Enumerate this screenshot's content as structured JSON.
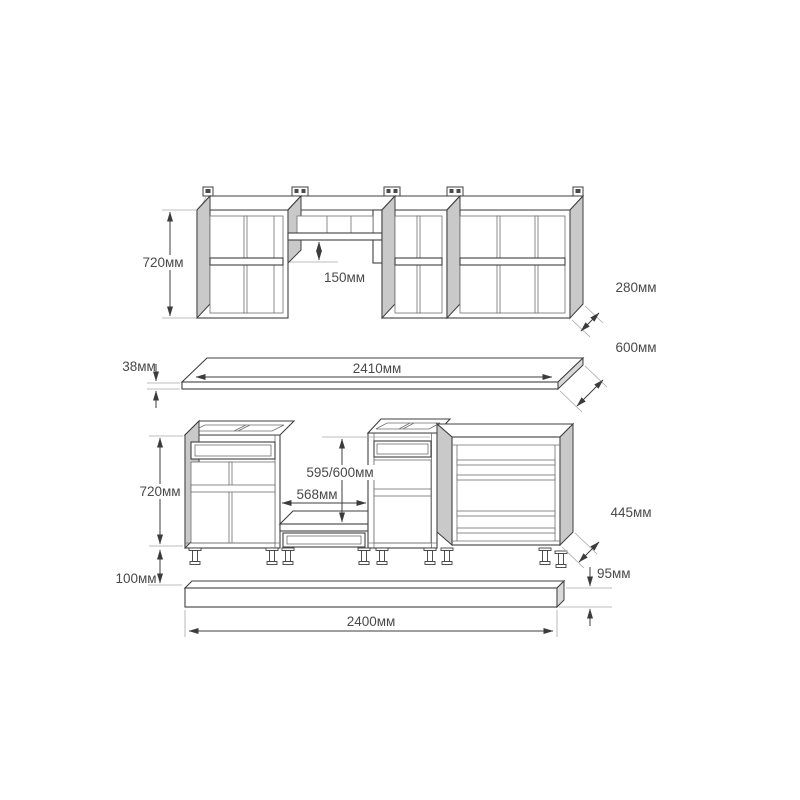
{
  "drawing": {
    "upper_cabinets": {
      "height": "720мм",
      "hood_shelf_offset": "150мм",
      "depth": "280мм"
    },
    "countertop": {
      "thickness": "38мм",
      "length": "2410мм",
      "depth": "600мм"
    },
    "base_cabinets": {
      "height": "720мм",
      "opening_height": "595/600мм",
      "opening_width": "568мм",
      "depth": "445мм",
      "legs_height": "100мм"
    },
    "plinth": {
      "height": "95мм",
      "length": "2400мм"
    }
  }
}
